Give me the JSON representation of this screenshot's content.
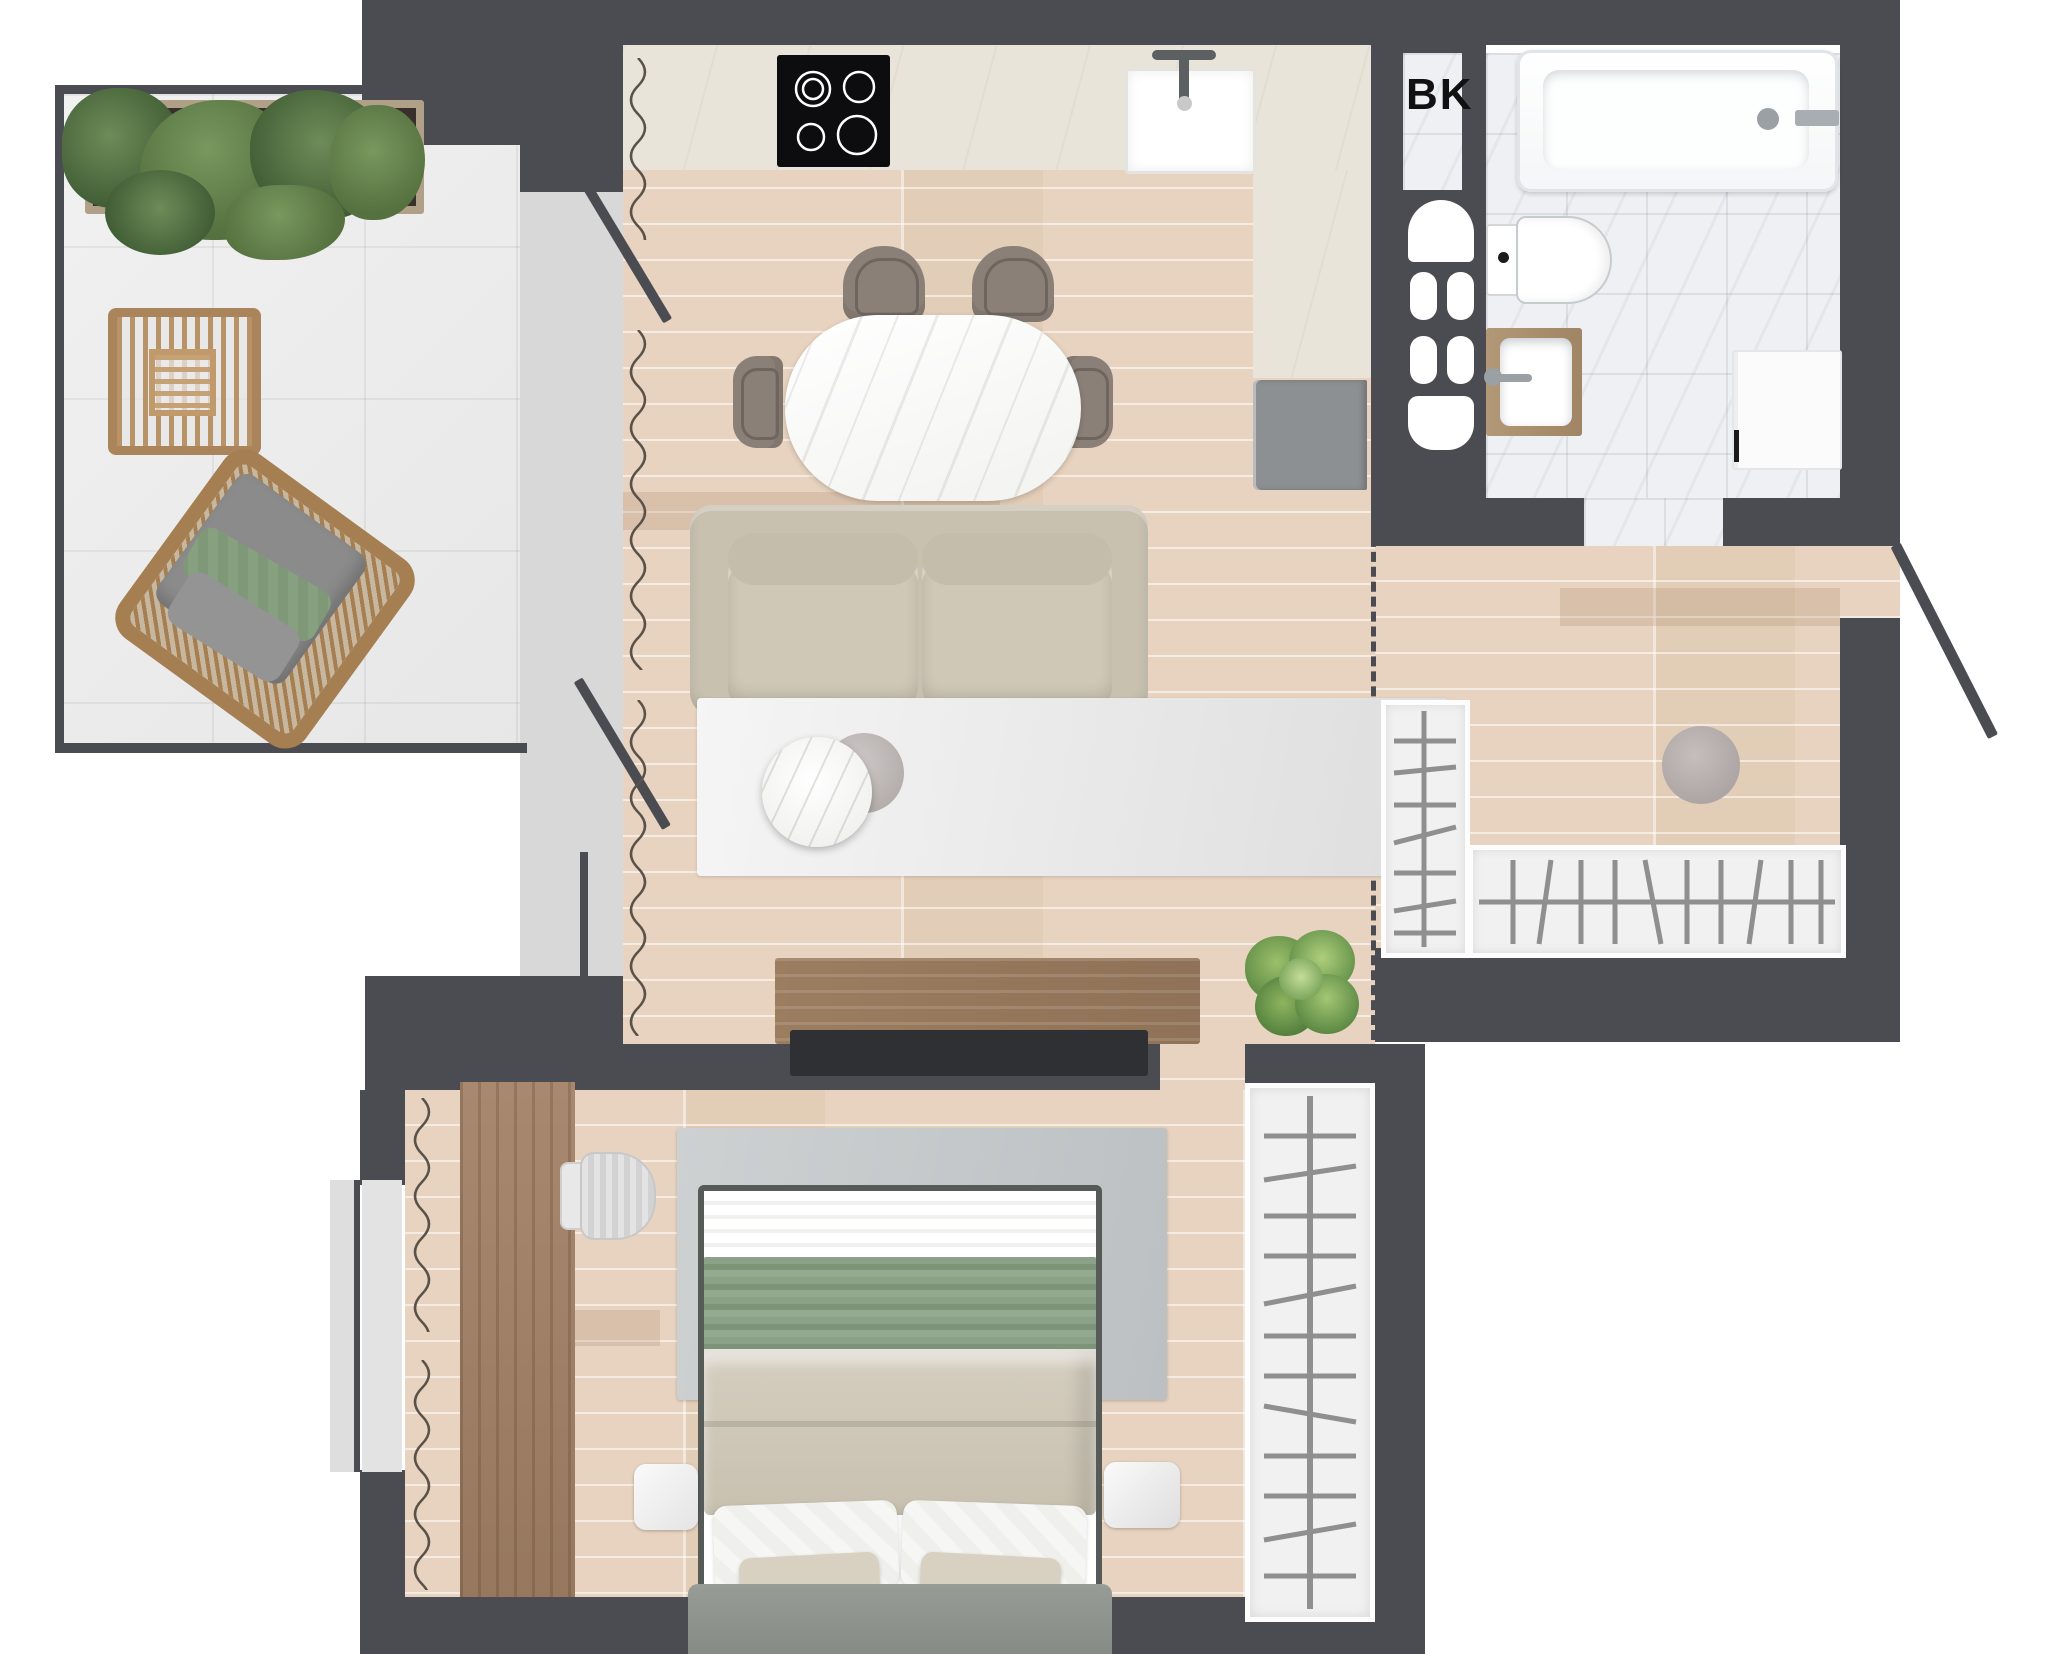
{
  "labels": {
    "bk": "BK"
  },
  "colors": {
    "wall": "#4b4b52",
    "wood_floor": "#e7d3bf",
    "balcony_tile": "#ededed",
    "bathroom_marble": "#eef0f3",
    "kitchen_stone": "#e9e4da",
    "sofa": "#c8c1b0",
    "dining_chair": "#8b8077",
    "bed_green_blanket": "#8ba288",
    "bed_duvet": "#cfc9ba",
    "rattan": "#aa845a",
    "plant_green": "#55713f",
    "furniture_wood": "#a08165",
    "appliance_gray": "#8d9092",
    "tv_black": "#2e3033"
  },
  "rooms": [
    {
      "id": "balcony",
      "items": [
        "planter-with-plants",
        "rattan-side-table",
        "rattan-lounge-chair",
        "tile-floor"
      ]
    },
    {
      "id": "living-kitchen",
      "items": [
        "induction-cooktop",
        "kitchen-sink",
        "kitchen-counter",
        "refrigerator",
        "dining-table",
        "dining-chair",
        "dining-chair",
        "dining-chair",
        "dining-chair",
        "sofa",
        "area-rug",
        "coffee-table",
        "pouf",
        "tv-console",
        "tv",
        "potted-plant",
        "curtain",
        "balcony-doors"
      ]
    },
    {
      "id": "bk-closet",
      "label": "BK",
      "items": [
        "utility-fixtures"
      ]
    },
    {
      "id": "bathroom",
      "items": [
        "bathtub",
        "toilet",
        "vanity-sink",
        "washing-machine"
      ]
    },
    {
      "id": "hallway",
      "items": [
        "wardrobe-vertical",
        "wardrobe-horizontal",
        "pouf",
        "entry-door"
      ]
    },
    {
      "id": "bedroom",
      "items": [
        "double-bed",
        "bedroom-rug",
        "wardrobe",
        "desk",
        "office-chair",
        "nightstand",
        "nightstand",
        "curtain",
        "window-panels"
      ]
    }
  ]
}
